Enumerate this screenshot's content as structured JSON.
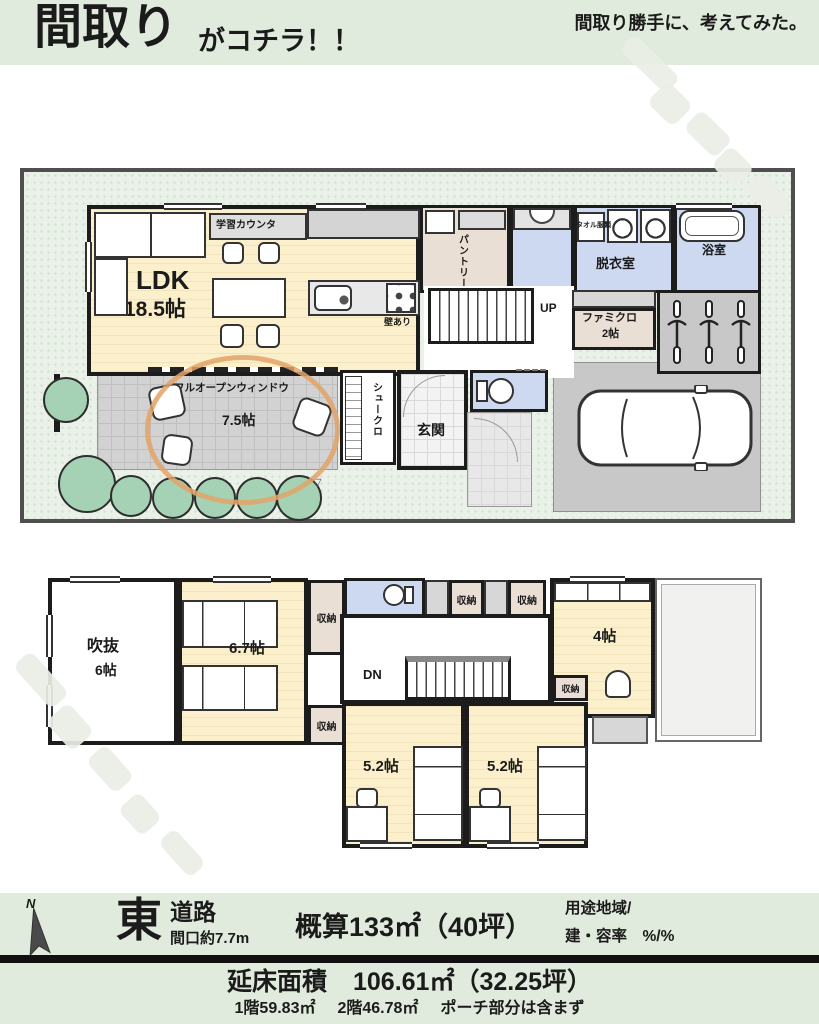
{
  "header": {
    "title_main": "間取り",
    "title_sub": "がコチラ！！",
    "tagline": "間取り勝手に、考えてみた。"
  },
  "floor1": {
    "ldk_name": "LDK",
    "ldk_size": "18.5帖",
    "study_counter": "学習カウンタ",
    "wall_note": "壁あり",
    "pantry": "パントリー",
    "towel_note": "タオル服類",
    "dressing_room": "脱衣室",
    "bath": "浴室",
    "stairs_up": "UP",
    "family_closet": "ファミクロ",
    "family_closet_size": "2帖",
    "terrace_window": "フルオープンウィンドウ",
    "terrace_size": "7.5帖",
    "shoe_closet": "シュークロ",
    "entrance": "玄関",
    "marker": "▽"
  },
  "floor2": {
    "void_name": "吹抜",
    "void_size": "6帖",
    "bedroom_main_size": "6.7帖",
    "storage": "収納",
    "stairs_dn": "DN",
    "room4_size": "4帖",
    "bedroom_a_size": "5.2帖",
    "bedroom_b_size": "5.2帖"
  },
  "info": {
    "compass": "N",
    "direction": "東",
    "road": "道路",
    "frontage": "間口約7.7m",
    "area_estimate": "概算133㎡（40坪）",
    "zoning": "用途地域/",
    "ratio": "建・容率　%/%",
    "total_label": "延床面積",
    "total_value": "106.61㎡（32.25坪）",
    "floor1_area": "1階59.83㎡",
    "floor2_area": "2階46.78㎡",
    "porch_note": "ポーチ部分は含まず"
  },
  "colors": {
    "band_green": "#e1ebdd",
    "lot_green": "#e9f1e8",
    "floor_cream": "#fbf0cb",
    "wet_blue": "#ccd9f0",
    "closet_beige": "#eadfd4",
    "terrace_gray": "#d2d2d2",
    "parking_gray": "#c8c8c8",
    "wall": "#1c1c1c",
    "annotation_orange": "#e2a368",
    "tree_green": "#a5d2b4"
  }
}
